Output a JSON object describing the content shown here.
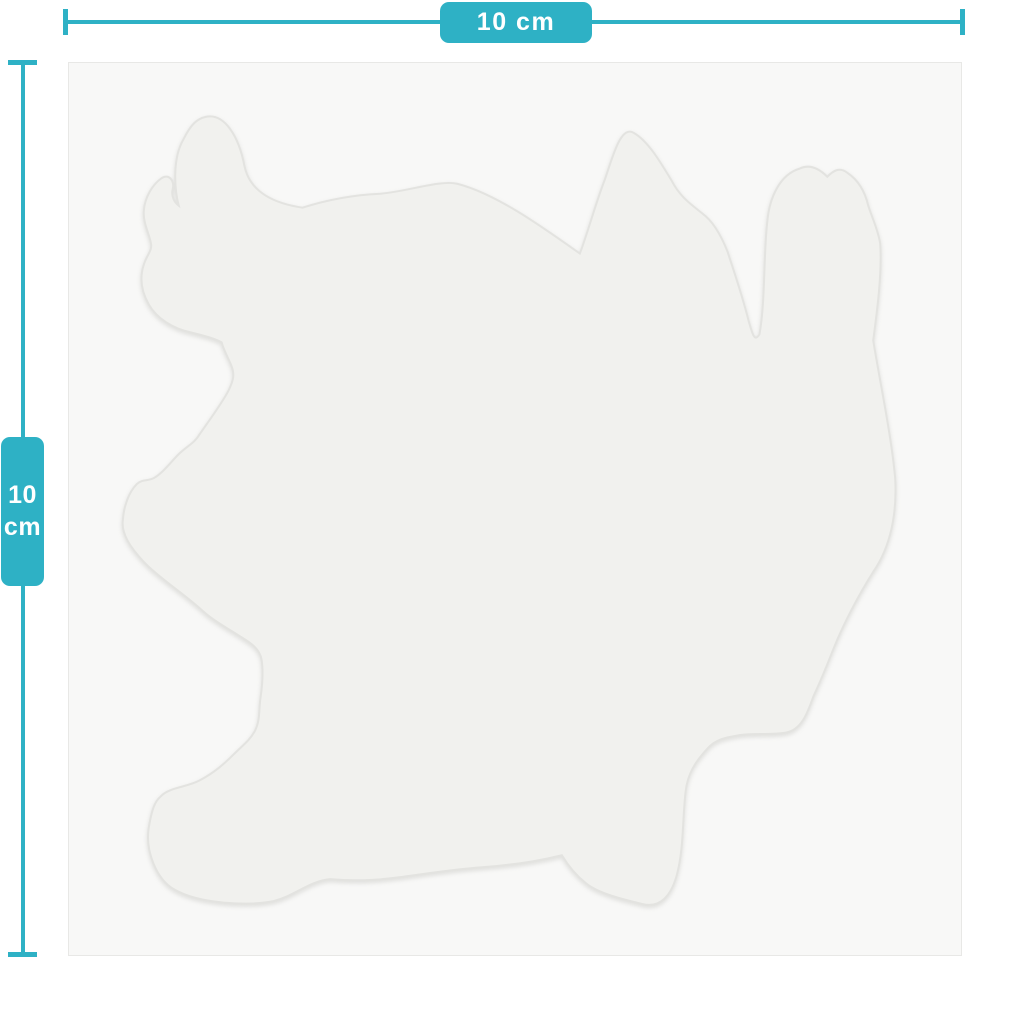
{
  "colors": {
    "accent": "#2EB1C5",
    "page_bg": "#FFFFFF",
    "canvas_bg": "#F8F8F7",
    "canvas_border": "#E8E8E6",
    "sticker_fill": "#F1F1EE",
    "sticker_stroke": "#E3E3E0",
    "label_text": "#FFFFFF"
  },
  "dimensions": {
    "width_label": "10 cm",
    "height_value": "10",
    "height_unit": "cm"
  }
}
